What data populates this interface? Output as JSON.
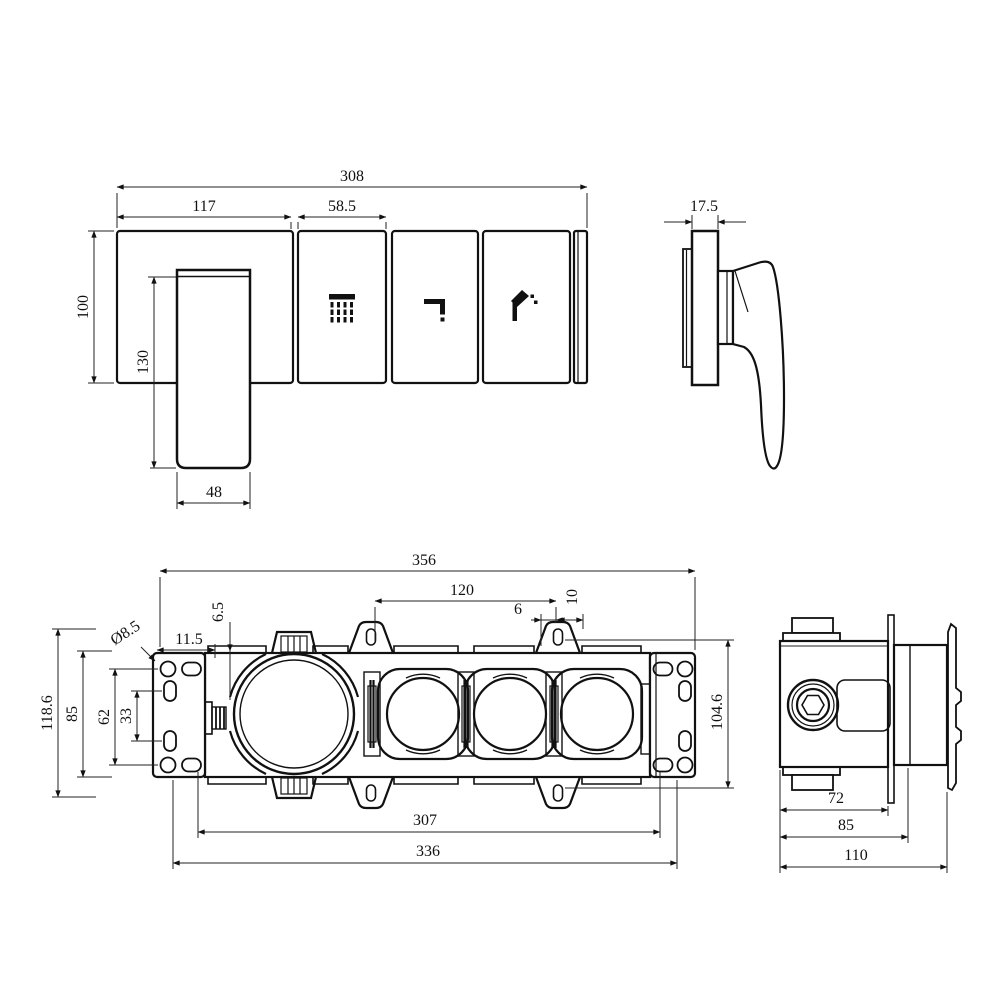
{
  "colors": {
    "line": "#111111",
    "background": "#ffffff"
  },
  "views": {
    "panel_front": {
      "dims": {
        "overall_width": "308",
        "section_width": "117",
        "button_width": "58.5",
        "panel_height": "100",
        "handle_length": "130",
        "handle_width": "48"
      },
      "icons": [
        {
          "name": "rain-shower-icon"
        },
        {
          "name": "spout-icon"
        },
        {
          "name": "hand-shower-icon"
        }
      ]
    },
    "panel_side": {
      "dims": {
        "trim_thickness": "17.5"
      }
    },
    "bracket_front": {
      "dims": {
        "overall_width": "356",
        "port_spacing": "120",
        "tab_slot_offset": "6",
        "tab_slot_width": "10",
        "housing_gap": "6.5",
        "hole_offset": "11.5",
        "hole_diameter": "Ø8.5",
        "overall_height": "118.6",
        "plate_height": "85",
        "slot_row_span": "62",
        "slot_pitch": "33",
        "tab_hole_span": "104.6",
        "mount_hole_span": "307",
        "outer_hole_span": "336"
      }
    },
    "box_side": {
      "dims": {
        "body_depth": "72",
        "plate_depth": "85",
        "overall_depth": "110"
      }
    }
  }
}
